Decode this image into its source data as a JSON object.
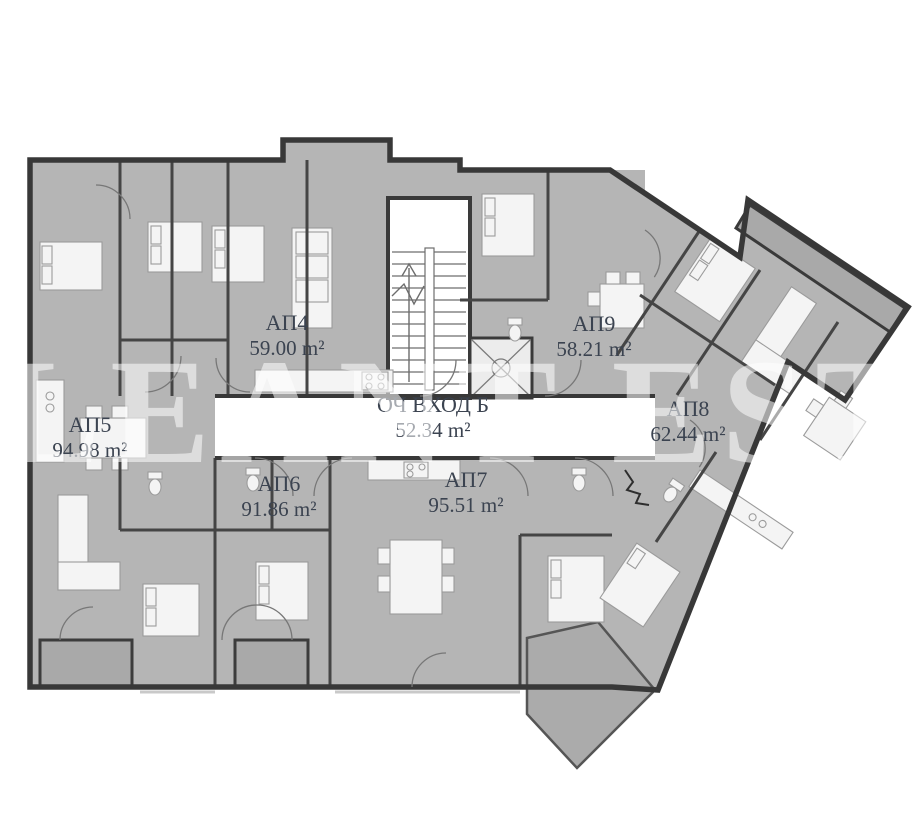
{
  "plan": {
    "title": "apartment-building-floor-plan",
    "watermark": "ALEANT ESTA",
    "units": [
      {
        "key": "ap4",
        "name": "АП4",
        "area": "59.00 m²"
      },
      {
        "key": "ap5",
        "name": "АП5",
        "area": "94.98 m²"
      },
      {
        "key": "ap6",
        "name": "АП6",
        "area": "91.86 m²"
      },
      {
        "key": "ap7",
        "name": "АП7",
        "area": "95.51 m²"
      },
      {
        "key": "ap8",
        "name": "АП8",
        "area": "62.44 m²"
      },
      {
        "key": "ap9",
        "name": "АП9",
        "area": "58.21 m²"
      },
      {
        "key": "entrance",
        "name": "ОЧ ВХОД Б",
        "area": "52.34 m²"
      }
    ],
    "colors": {
      "room_fill": "#b5b5b5",
      "balcony_fill": "#a9a9a9",
      "wall": "#3a3a3a",
      "furniture": "#f4f4f4",
      "label_text": "#3b4350",
      "watermark": "#ffffff"
    }
  }
}
